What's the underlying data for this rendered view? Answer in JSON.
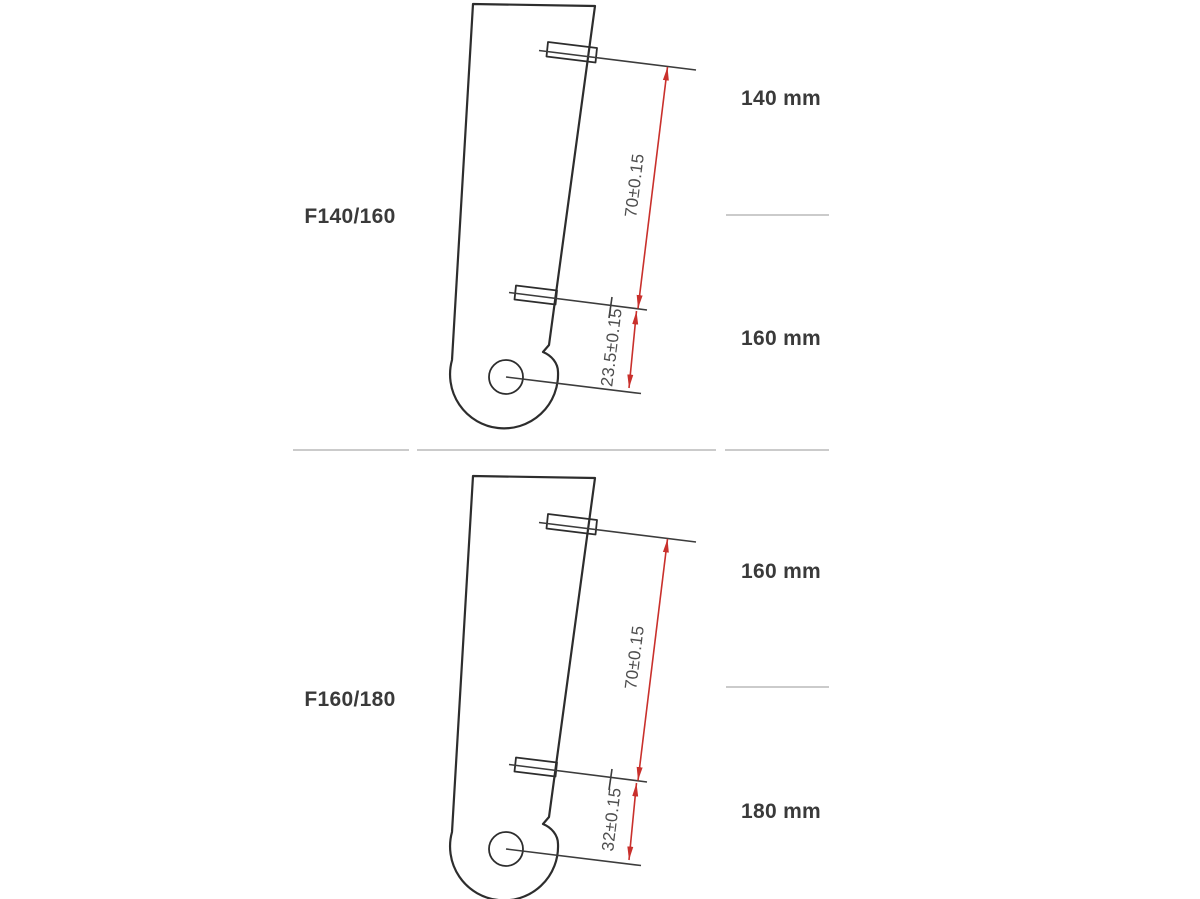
{
  "colors": {
    "background": "#ffffff",
    "fork_outline": "#2d2d2d",
    "extension_line": "#3c3c3c",
    "dimension_red": "#c9302c",
    "divider_gray": "#cbcbcb",
    "label_text": "#3a3a3a",
    "dimension_text": "#4e4e4e"
  },
  "rows": [
    {
      "model": "F140/160",
      "travel_option_top": "140 mm",
      "travel_option_bottom": "160 mm",
      "post_mount_spacing": "70±0.15",
      "lower_mount_to_axle": "23.5±0.15"
    },
    {
      "model": "F160/180",
      "travel_option_top": "160 mm",
      "travel_option_bottom": "180 mm",
      "post_mount_spacing": "70±0.15",
      "lower_mount_to_axle": "32±0.15"
    }
  ]
}
